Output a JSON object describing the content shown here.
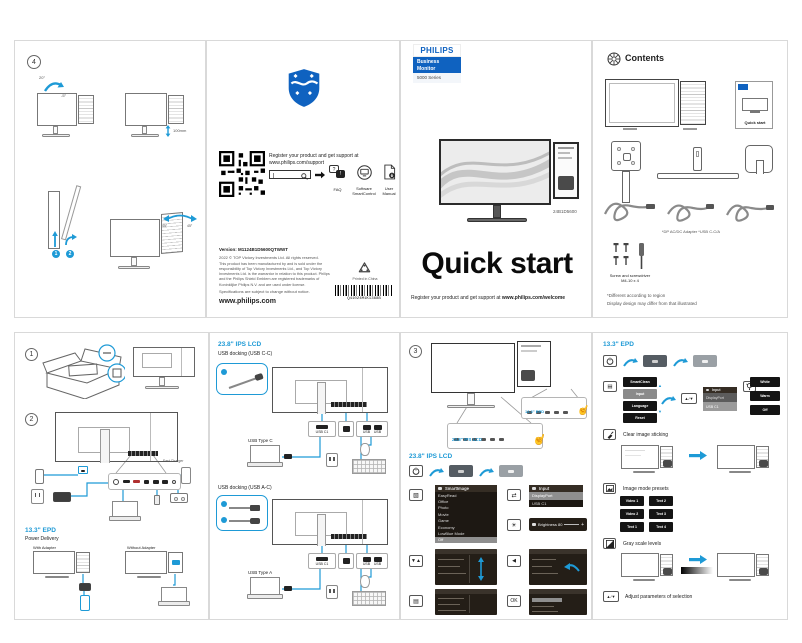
{
  "colors": {
    "accent": "#1e9ad6",
    "brand": "#0f62c0",
    "ink": "#222222"
  },
  "panel4": {
    "step": "4",
    "tilt_max": "20°",
    "tilt_min": "-5°",
    "height_range": "100mm",
    "swivel_left": "45°",
    "swivel_right": "45°",
    "pivot_step1": "1",
    "pivot_step2": "2"
  },
  "register": {
    "line1": "Register your product and get support at",
    "line2": "www.philips.com/support",
    "faq": "FAQ",
    "software1": "Software",
    "software2": "SmartControl",
    "manual1": "User",
    "manual2": "Manual",
    "version": "Version: M1124B1D5600QTWWT",
    "copyright": "2022 © TOP Victory Investments Ltd. All rights reserved.",
    "legal": "This product has been manufactured by and is sold under the responsibility of Top Victory Investments Ltd., and Top Victory Investments Ltd. is the warrantor in relation to this product. Philips and the Philips Shield Emblem are registered trademarks of Koninklijke Philips N.V. and are used under license.",
    "disclaimer": "Specifications are subject to change without notice.",
    "website": "www.philips.com",
    "printed": "Printed in China",
    "barcode": "Q41024M1K1368B"
  },
  "cover": {
    "brand": "PHILIPS",
    "tag1": "Business",
    "tag2": "Monitor",
    "series": "5000 Series",
    "model": "24B1D5600",
    "title": "Quick start",
    "register": "Register your product and get support at",
    "register_url": "www.philips.com/welcome"
  },
  "contents": {
    "heading": "Contents",
    "card": "Quick start",
    "adapter_note": "*DP   AC/DC Adapter   *USB C-C/A",
    "screw1": "Screw and screwdriver",
    "screw2": "M4-10 x 4",
    "foot1": "*Different according to region",
    "foot2": "Display design may differ from that illustrated"
  },
  "setup": {
    "step1": "1",
    "step2": "2",
    "fast_charger": "Fast Charger",
    "epd": "13.3\" EPD",
    "pd": "Power Delivery",
    "with_adapter": "With Adapter",
    "without_adapter": "Without Adapter"
  },
  "docking": {
    "heading": "23.8\" IPS LCD",
    "mode1": "USB docking (USB C-C)",
    "mode2": "USB docking (USB A-C)",
    "port_usbc": "USB C1",
    "usb_label": "USB",
    "laptop1": "USB Type C",
    "laptop2": "USB Type A"
  },
  "osd": {
    "step": "3",
    "callout_epd": "13.3\" EPD",
    "callout_lcd": "23.8\" IPS LCD",
    "heading": "23.8\" IPS LCD",
    "smartimage_header": "SmartImage",
    "smartimage_items": [
      "EasyRead",
      "Office",
      "Photo",
      "Movie",
      "Game",
      "Economy",
      "LowBlue Mode",
      "Off"
    ],
    "input_header": "Input",
    "input_items": [
      "DisplayPort",
      "USB C1"
    ],
    "brightness": "Brightness 80",
    "slider_plus": "+",
    "key_updown": "▼▲",
    "key_back": "◀",
    "key_ok": "OK",
    "key_menu": "▤",
    "key_smartimage": "▧",
    "key_input": "⇄",
    "key_brightness": "☀"
  },
  "epd": {
    "heading": "13.3\" EPD",
    "key_menu": "▤",
    "keys_updown": "▲/▼",
    "menu_items": [
      "SmartClean",
      "Input",
      "Language",
      "Reset"
    ],
    "submenu_header": "Input",
    "submenu_items": [
      "DisplayPort",
      "USB C1"
    ],
    "frontlight": [
      "White",
      "Warm",
      "Off"
    ],
    "clear": "Clear image sticking",
    "presets_label": "Image mode presets",
    "presets": [
      "Video 1",
      "Video 2",
      "Text 1",
      "Text 2",
      "Text 3",
      "Text 4"
    ],
    "gray": "Gray scale levels",
    "adjust": "Adjust parameters of selection"
  }
}
